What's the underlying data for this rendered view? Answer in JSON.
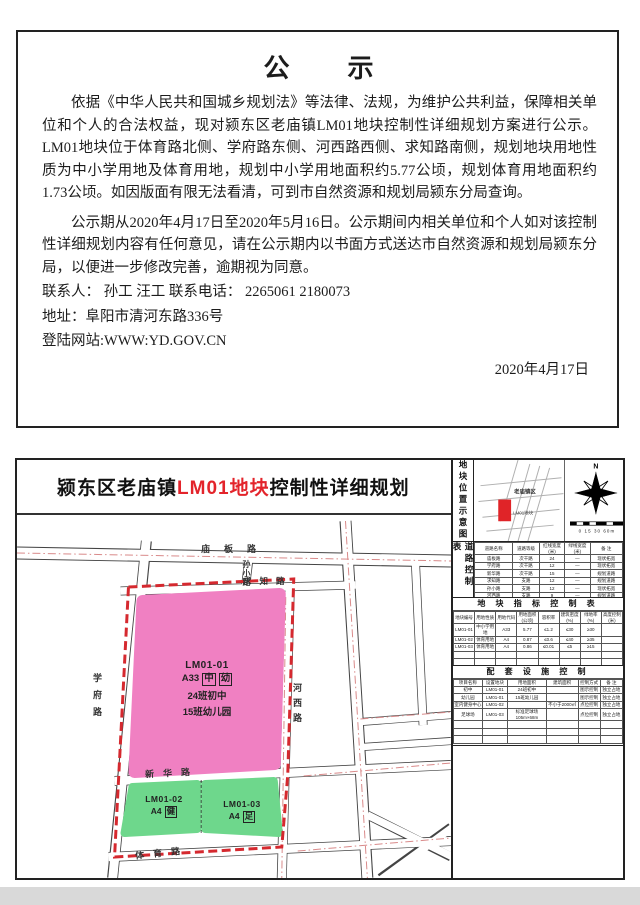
{
  "notice": {
    "title": "公　　示",
    "paragraph1": "依据《中华人民共和国城乡规划法》等法律、法规，为维护公共利益，保障相关单位和个人的合法权益，现对颍东区老庙镇LM01地块控制性详细规划方案进行公示。LM01地块位于体育路北侧、学府路东侧、河西路西侧、求知路南侧，规划地块用地性质为中小学用地及体育用地，规划中小学用地面积约5.77公顷，规划体育用地面积约1.73公顷。如因版面有限无法看清，可到市自然资源和规划局颍东分局查询。",
    "paragraph2": "公示期从2020年4月17日至2020年5月16日。公示期间内相关单位和个人如对该控制性详细规划内容有任何意见，请在公示期内以书面方式送达市自然资源和规划局颍东分局，以便进一步修改完善，逾期视为同意。",
    "contact_line": "联系人：  孙工  汪工  联系电话：  2265061  2180073",
    "address_line": "地址：阜阳市清河东路336号",
    "website_line": "登陆网站:WWW:YD.GOV.CN",
    "date": "2020年4月17日"
  },
  "plan": {
    "title": {
      "prefix": "颍东区老庙镇",
      "highlight": "LM01地块",
      "suffix": "控制性详细规划"
    },
    "colors": {
      "pink_block": "#f080c2",
      "green_block": "#6ed78c",
      "boundary_red": "#d5292f",
      "centerline_red": "#d98a8a",
      "title_red": "#e3242b",
      "marker_red": "#e02428"
    },
    "map": {
      "road_labels": {
        "miaoban": "庙板路",
        "sunxiao": "孙小路",
        "qiuzhi": "求知路",
        "xuefu": "学府路",
        "hexi": "河西路",
        "xinhua": "新华路",
        "tiyu": "体育路"
      },
      "blocks": {
        "b1": {
          "id": "LM01-01",
          "code": "A33",
          "tag1": "中",
          "tag2": "幼",
          "line3": "24班初中",
          "line4": "15班幼儿园"
        },
        "b2": {
          "id": "LM01-02",
          "code": "A4",
          "tag": "健"
        },
        "b3": {
          "id": "LM01-03",
          "code": "A4",
          "tag": "足"
        }
      }
    },
    "sidebar": {
      "location_label": "地块位置示意图",
      "inset": {
        "town": "老庙镇区",
        "block": "LM01地块",
        "north": "N",
        "scale_text": "0 15 30  60m"
      },
      "road_table": {
        "label": "道路控制表",
        "headers": [
          "道路名称",
          "道路等级",
          "红线宽度\n(米)",
          "绿线宽度\n(米)",
          "备 注"
        ],
        "rows": [
          [
            "庙板路",
            "次干路",
            "24",
            "—",
            "现状拓宽"
          ],
          [
            "学府路",
            "次干路",
            "12",
            "—",
            "现状拓宽"
          ],
          [
            "新华路",
            "次干路",
            "15",
            "—",
            "规划道路"
          ],
          [
            "求知路",
            "支路",
            "12",
            "—",
            "规划道路"
          ],
          [
            "孙小路",
            "支路",
            "12",
            "—",
            "现状拓宽"
          ],
          [
            "河西路",
            "支路",
            "9",
            "—",
            "规划道路"
          ],
          [
            "体育路",
            "支路",
            "9",
            "—",
            "规划道路"
          ]
        ]
      },
      "index_table": {
        "title": "地 块 指 标 控 制 表",
        "headers": [
          "地块编号",
          "用地性质",
          "用地代码",
          "用地面积\n(公顷)",
          "容积率",
          "建筑密度\n(%)",
          "绿地率\n(%)",
          "高度控制\n(米)"
        ],
        "rows": [
          [
            "LM01-01",
            "中小学用地",
            "A33",
            "5.77",
            "≤1.2",
            "≤30",
            "≥30",
            ""
          ],
          [
            "LM01-02",
            "体育用地",
            "A4",
            "0.87",
            "≤0.6",
            "≤40",
            "≥35",
            ""
          ],
          [
            "LM01-03",
            "体育用地",
            "A4",
            "0.86",
            "≤0.01",
            "≤5",
            "≥15",
            ""
          ]
        ]
      },
      "facility_table": {
        "title": "配 套 设 施 控 制",
        "headers": [
          "项目名称",
          "设置地块",
          "用地面积",
          "建筑面积",
          "控制方式",
          "备 注"
        ],
        "rows": [
          [
            "初中",
            "LM01-01",
            "24班初中",
            "",
            "图示控制",
            "独立占地"
          ],
          [
            "幼儿园",
            "LM01-01",
            "15班幼儿园",
            "",
            "图示控制",
            "独立占地"
          ],
          [
            "室内健身中心",
            "LM01-02",
            "",
            "不小于2000㎡",
            "点位控制",
            "独立占地"
          ],
          [
            "足球场",
            "LM01-03",
            "标准足球场105m×68m",
            "",
            "点位控制",
            "独立占地"
          ]
        ]
      }
    }
  }
}
